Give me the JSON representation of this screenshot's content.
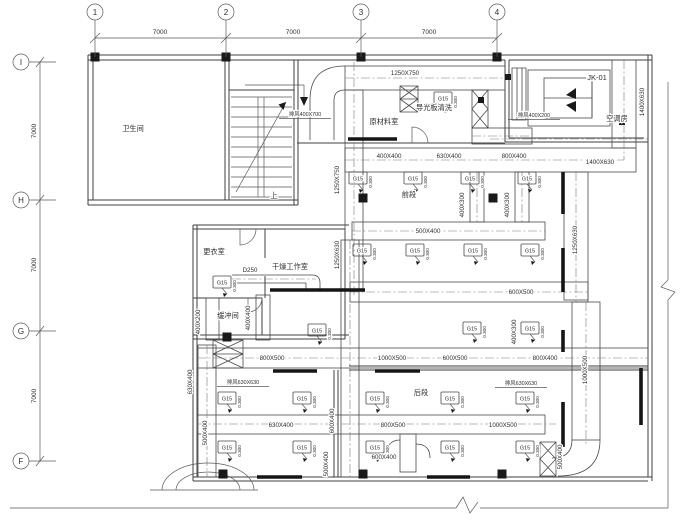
{
  "drawing": {
    "grid": {
      "cols": [
        {
          "label": "1",
          "x": 95
        },
        {
          "label": "2",
          "x": 226
        },
        {
          "label": "3",
          "x": 361
        },
        {
          "label": "4",
          "x": 497
        }
      ],
      "rows": [
        {
          "label": "I",
          "y": 62
        },
        {
          "label": "H",
          "y": 200
        },
        {
          "label": "G",
          "y": 331
        },
        {
          "label": "F",
          "y": 461
        }
      ],
      "col_spans": [
        {
          "text": "7000",
          "x": 160
        },
        {
          "text": "7000",
          "x": 293
        },
        {
          "text": "7000",
          "x": 429
        }
      ],
      "row_spans": [
        {
          "text": "7000",
          "y": 131
        },
        {
          "text": "7000",
          "y": 265
        },
        {
          "text": "7000",
          "y": 396
        }
      ]
    },
    "rooms": [
      {
        "name": "卫生间",
        "x": 133,
        "y": 131
      },
      {
        "name": "原材料室",
        "x": 384,
        "y": 124
      },
      {
        "name": "导光板清洗",
        "x": 434,
        "y": 110
      },
      {
        "name": "空调房",
        "x": 617,
        "y": 121
      },
      {
        "name": "更衣室",
        "x": 214,
        "y": 254
      },
      {
        "name": "干燥工作室",
        "x": 290,
        "y": 269
      },
      {
        "name": "缓冲间",
        "x": 228,
        "y": 318
      },
      {
        "name": "前段",
        "x": 409,
        "y": 197
      },
      {
        "name": "后段",
        "x": 421,
        "y": 395
      },
      {
        "name": "上",
        "x": 274,
        "y": 198
      }
    ],
    "equipment_label": {
      "text": "JK-01",
      "x": 597,
      "y": 80
    },
    "duct_labels": [
      {
        "t": "1250X750",
        "x": 405,
        "y": 75
      },
      {
        "t": "400X400",
        "x": 389,
        "y": 158
      },
      {
        "t": "630X400",
        "x": 449,
        "y": 158
      },
      {
        "t": "800X400",
        "x": 514,
        "y": 158
      },
      {
        "t": "1400X630",
        "x": 600,
        "y": 164
      },
      {
        "t": "500X400",
        "x": 428,
        "y": 233
      },
      {
        "t": "600X500",
        "x": 521,
        "y": 294
      },
      {
        "t": "800X500",
        "x": 272,
        "y": 360
      },
      {
        "t": "1000X500",
        "x": 392,
        "y": 360
      },
      {
        "t": "600X500",
        "x": 455,
        "y": 360
      },
      {
        "t": "800X400",
        "x": 545,
        "y": 360
      },
      {
        "t": "630X400",
        "x": 281,
        "y": 427
      },
      {
        "t": "800X500",
        "x": 393,
        "y": 427
      },
      {
        "t": "1000X500",
        "x": 503,
        "y": 427
      },
      {
        "t": "600X400",
        "x": 384,
        "y": 459
      },
      {
        "t": "D250",
        "x": 250,
        "y": 272
      },
      {
        "t": "1250X750",
        "x": 339,
        "y": 180,
        "r": 1
      },
      {
        "t": "1250X630",
        "x": 339,
        "y": 255,
        "r": 1
      },
      {
        "t": "1400X630",
        "x": 644,
        "y": 102,
        "r": 1
      },
      {
        "t": "1250X630",
        "x": 577,
        "y": 240,
        "r": 1
      },
      {
        "t": "1000X500",
        "x": 587,
        "y": 370,
        "r": 1
      },
      {
        "t": "400X300",
        "x": 464,
        "y": 205,
        "r": 1
      },
      {
        "t": "400X300",
        "x": 509,
        "y": 205,
        "r": 1
      },
      {
        "t": "400X300",
        "x": 516,
        "y": 332,
        "r": 1
      },
      {
        "t": "400X200",
        "x": 200,
        "y": 322,
        "r": 1
      },
      {
        "t": "400X400",
        "x": 250,
        "y": 318,
        "r": 1
      },
      {
        "t": "630X400",
        "x": 192,
        "y": 382,
        "r": 1
      },
      {
        "t": "500X400",
        "x": 207,
        "y": 433,
        "r": 1
      },
      {
        "t": "600X400",
        "x": 334,
        "y": 421,
        "r": 1
      },
      {
        "t": "500X400",
        "x": 328,
        "y": 464,
        "r": 1
      },
      {
        "t": "500X400",
        "x": 562,
        "y": 457,
        "r": 1
      }
    ],
    "exhaust_labels": [
      {
        "text": "排风400X700",
        "x": 305,
        "y": 116
      },
      {
        "text": "排风400X200",
        "x": 534,
        "y": 117
      },
      {
        "text": "排风630X630",
        "x": 243,
        "y": 384
      },
      {
        "text": "排风630X630",
        "x": 521,
        "y": 385
      }
    ],
    "diffusers": {
      "label": "G15",
      "elevation": "0.300",
      "positions": [
        [
          443,
          98
        ],
        [
          358,
          178
        ],
        [
          413,
          178
        ],
        [
          470,
          178
        ],
        [
          527,
          178
        ],
        [
          362,
          250
        ],
        [
          415,
          250
        ],
        [
          473,
          250
        ],
        [
          530,
          250
        ],
        [
          222,
          282
        ],
        [
          317,
          330
        ],
        [
          472,
          328
        ],
        [
          530,
          328
        ],
        [
          227,
          398
        ],
        [
          302,
          398
        ],
        [
          375,
          398
        ],
        [
          450,
          398
        ],
        [
          525,
          398
        ],
        [
          227,
          447
        ],
        [
          302,
          447
        ],
        [
          375,
          447
        ],
        [
          450,
          447
        ],
        [
          525,
          447
        ]
      ]
    },
    "colors": {
      "line": "#3f3f3f",
      "background": "#ffffff",
      "text": "#2e2e2e"
    }
  }
}
